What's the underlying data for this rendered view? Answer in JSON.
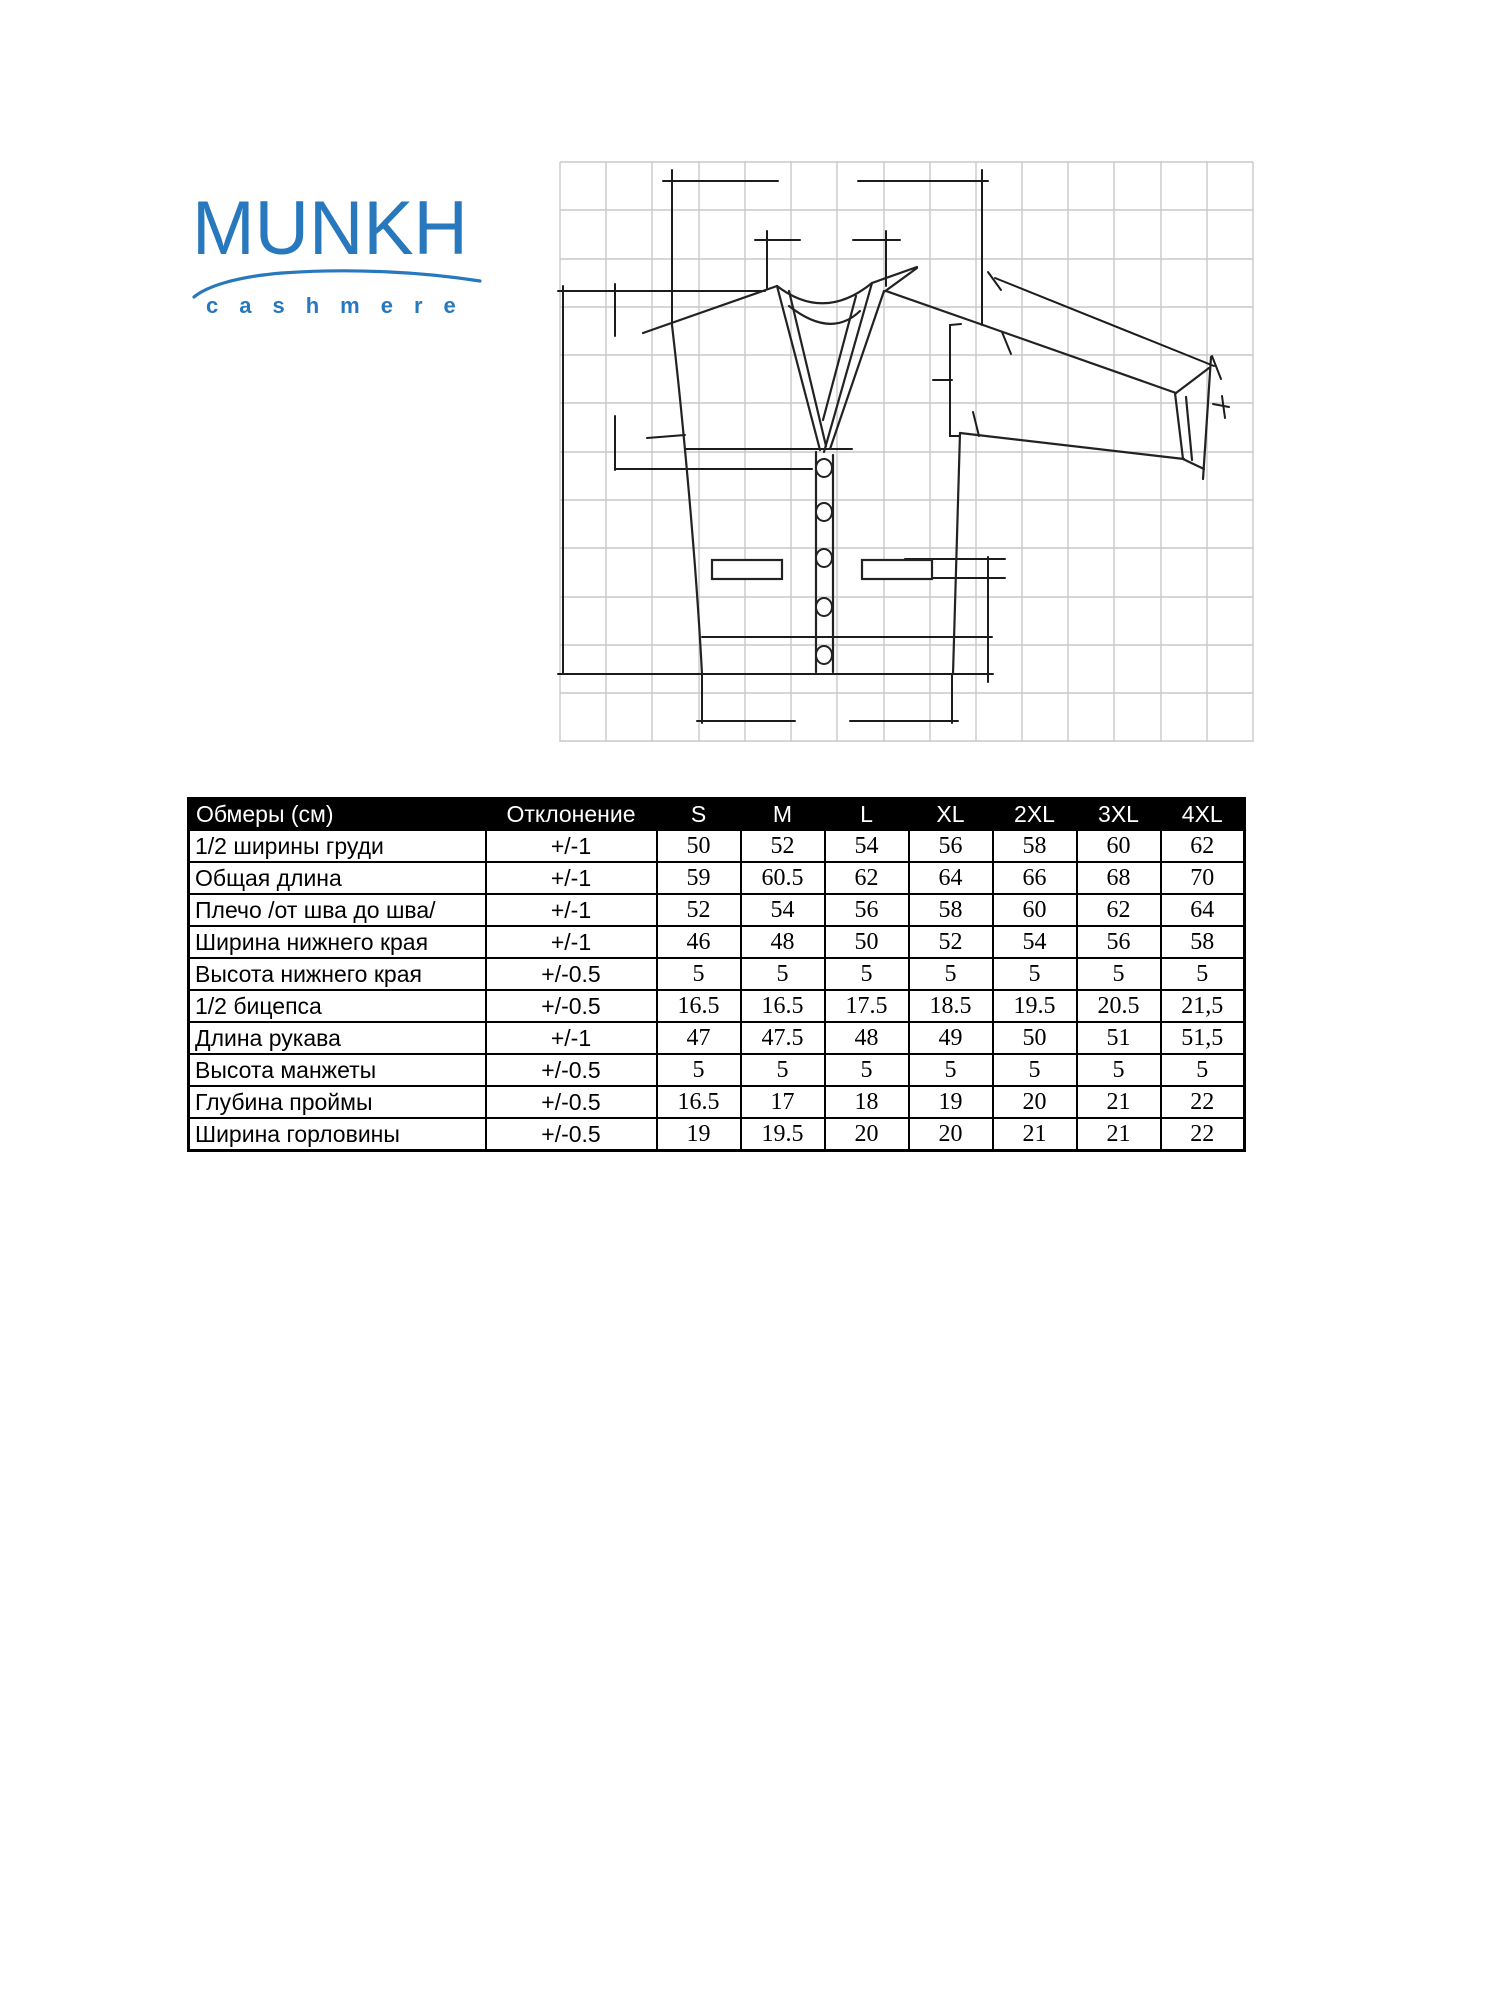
{
  "logo": {
    "brand": "MUNKH",
    "subtitle": "cashmere"
  },
  "colors": {
    "brand_blue": "#2878BE",
    "table_header_bg": "#000000",
    "table_header_text": "#FFFFFF",
    "grid_line": "#C9C9C9",
    "sketch_line": "#1C1C1C"
  },
  "drawing": {
    "subject": "cardigan flat sketch with measurement lines on grid"
  },
  "table": {
    "columns": [
      "Обмеры (см)",
      "Отклонение",
      "S",
      "M",
      "L",
      "XL",
      "2XL",
      "3XL",
      "4XL"
    ],
    "rows": [
      {
        "label": "1/2 ширины груди",
        "tolerance": "+/-1",
        "values": [
          "50",
          "52",
          "54",
          "56",
          "58",
          "60",
          "62"
        ]
      },
      {
        "label": "Общая длина",
        "tolerance": "+/-1",
        "values": [
          "59",
          "60.5",
          "62",
          "64",
          "66",
          "68",
          "70"
        ]
      },
      {
        "label": "Плечо /от шва до шва/",
        "tolerance": "+/-1",
        "values": [
          "52",
          "54",
          "56",
          "58",
          "60",
          "62",
          "64"
        ]
      },
      {
        "label": "Ширина нижнего края",
        "tolerance": "+/-1",
        "values": [
          "46",
          "48",
          "50",
          "52",
          "54",
          "56",
          "58"
        ]
      },
      {
        "label": "Высота нижнего края",
        "tolerance": "+/-0.5",
        "values": [
          "5",
          "5",
          "5",
          "5",
          "5",
          "5",
          "5"
        ]
      },
      {
        "label": "1/2 бицепса",
        "tolerance": "+/-0.5",
        "values": [
          "16.5",
          "16.5",
          "17.5",
          "18.5",
          "19.5",
          "20.5",
          "21,5"
        ]
      },
      {
        "label": "Длина рукава",
        "tolerance": "+/-1",
        "values": [
          "47",
          "47.5",
          "48",
          "49",
          "50",
          "51",
          "51,5"
        ]
      },
      {
        "label": "Высота манжеты",
        "tolerance": "+/-0.5",
        "values": [
          "5",
          "5",
          "5",
          "5",
          "5",
          "5",
          "5"
        ]
      },
      {
        "label": "Глубина проймы",
        "tolerance": "+/-0.5",
        "values": [
          "16.5",
          "17",
          "18",
          "19",
          "20",
          "21",
          "22"
        ]
      },
      {
        "label": "Ширина горловины",
        "tolerance": "+/-0.5",
        "values": [
          "19",
          "19.5",
          "20",
          "20",
          "21",
          "21",
          "22"
        ]
      }
    ]
  }
}
